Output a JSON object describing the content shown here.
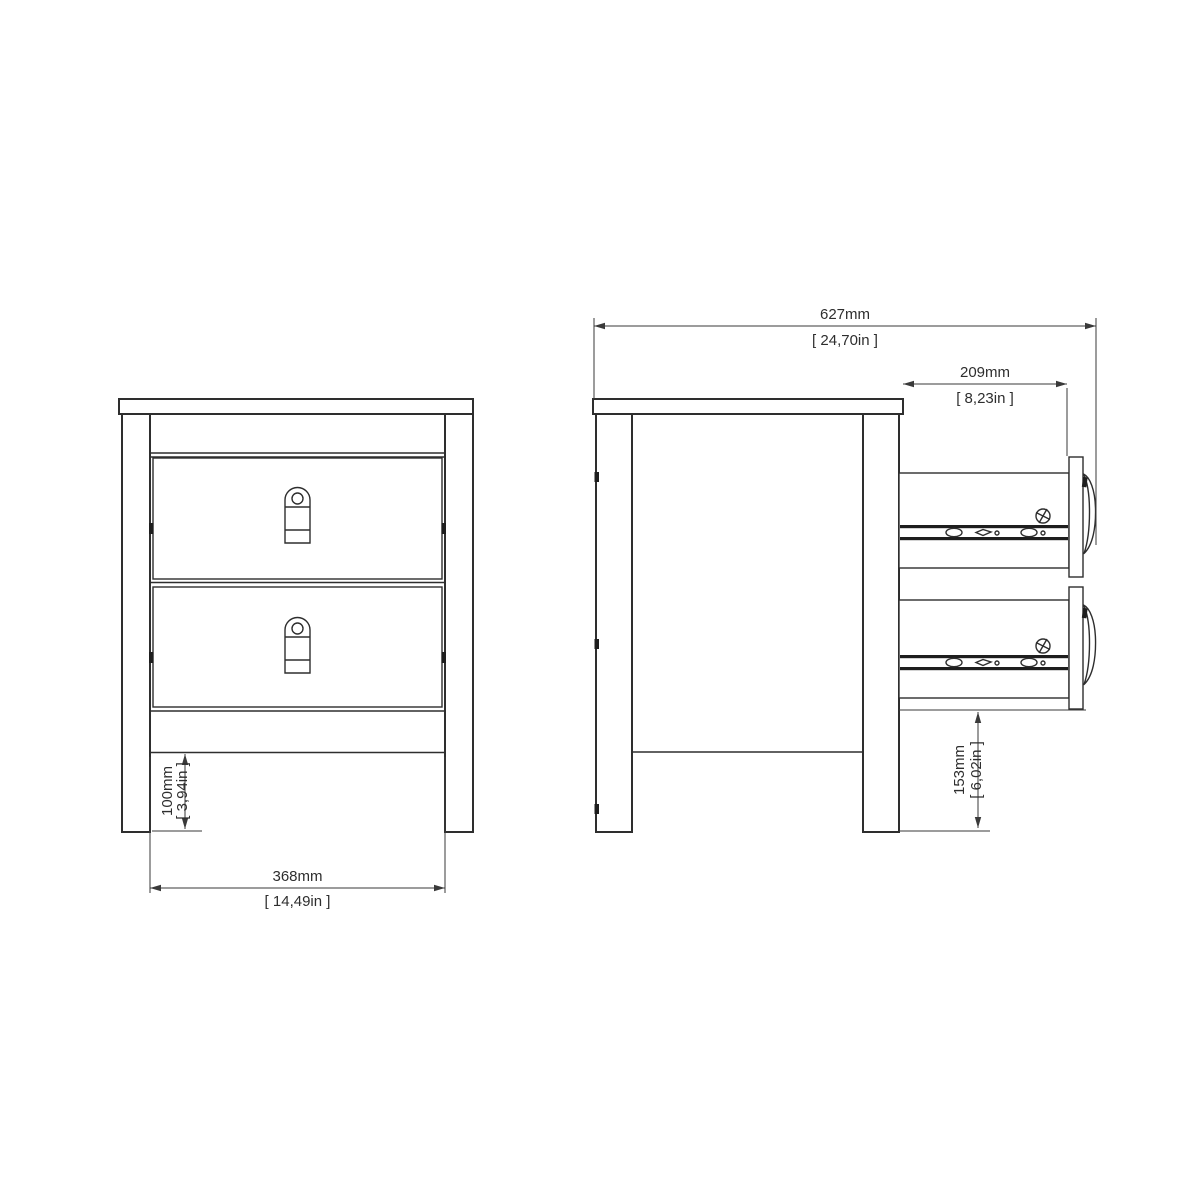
{
  "drawing": {
    "background_color": "#ffffff",
    "line_color": "#2e2e2e",
    "dimension_color": "#3a3a3a",
    "views": {
      "front": {
        "drawers": 2,
        "handles": 2
      },
      "side": {
        "drawers_open": 2,
        "slide_rails": 2,
        "strap_pulls": 2
      }
    },
    "dimensions": {
      "overall_depth": {
        "metric": "627mm",
        "imperial": "[ 24,70in ]"
      },
      "drawer_extension": {
        "metric": "209mm",
        "imperial": "[ 8,23in ]"
      },
      "internal_width": {
        "metric": "368mm",
        "imperial": "[ 14,49in ]"
      },
      "plinth_height": {
        "metric": "100mm",
        "imperial": "[ 3,94in ]"
      },
      "clearance_height": {
        "metric": "153mm",
        "imperial": "[ 6,02in ]"
      }
    }
  }
}
